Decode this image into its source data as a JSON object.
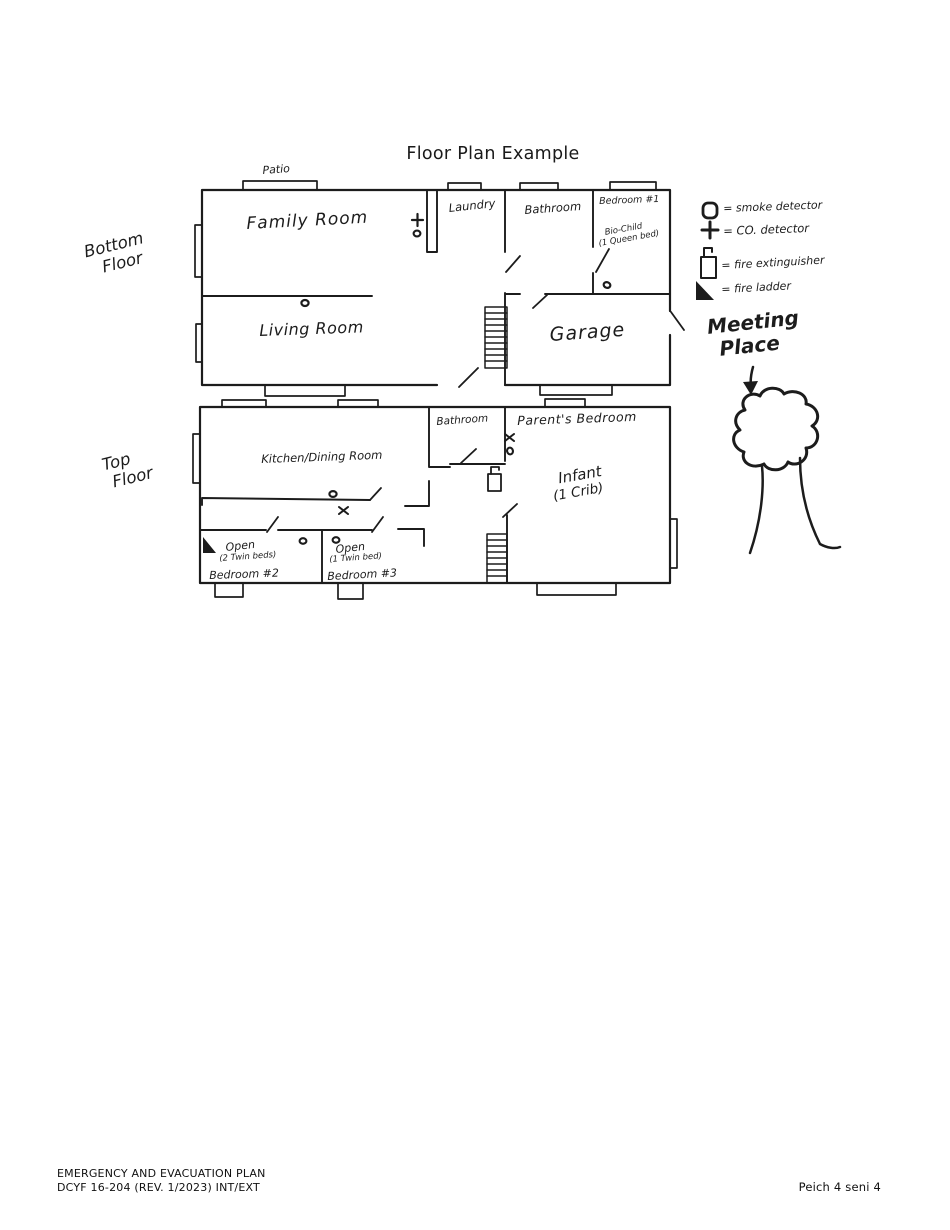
{
  "page": {
    "title": "Floor Plan Example"
  },
  "floor_section_labels": {
    "bottom": {
      "line1": "Bottom",
      "line2": "Floor"
    },
    "top": {
      "line1": "Top",
      "line2": "Floor"
    }
  },
  "bottom_floor": {
    "patio": "Patio",
    "family_room": "Family Room",
    "laundry": "Laundry",
    "bathroom": "Bathroom",
    "bedroom1": "Bedroom #1",
    "bedroom1_note_line1": "Bio-Child",
    "bedroom1_note_line2": "(1 Queen bed)",
    "living_room": "Living Room",
    "garage": "Garage"
  },
  "top_floor": {
    "kitchen_dining": "Kitchen/Dining Room",
    "bathroom": "Bathroom",
    "parents_bedroom": "Parent's Bedroom",
    "infant_line1": "Infant",
    "infant_line2": "(1 Crib)",
    "bedroom2_open": "Open",
    "bedroom2_beds": "(2 Twin beds)",
    "bedroom2_name": "Bedroom #2",
    "bedroom3_open": "Open",
    "bedroom3_beds": "(1 Twin bed)",
    "bedroom3_name": "Bedroom #3"
  },
  "legend": {
    "smoke_detector": "= smoke detector",
    "co_detector": "= CO. detector",
    "fire_extinguisher": "= fire extinguisher",
    "fire_ladder": "= fire ladder"
  },
  "meeting_place": {
    "line1": "Meeting",
    "line2": "Place"
  },
  "footer": {
    "doc_title": "EMERGENCY AND EVACUATION PLAN",
    "doc_number": "DCYF 16-204 (REV. 1/2023) INT/EXT",
    "page_number": "Peich 4 seni 4"
  },
  "colors": {
    "ink": "#1c1c1c",
    "paper": "#ffffff"
  }
}
